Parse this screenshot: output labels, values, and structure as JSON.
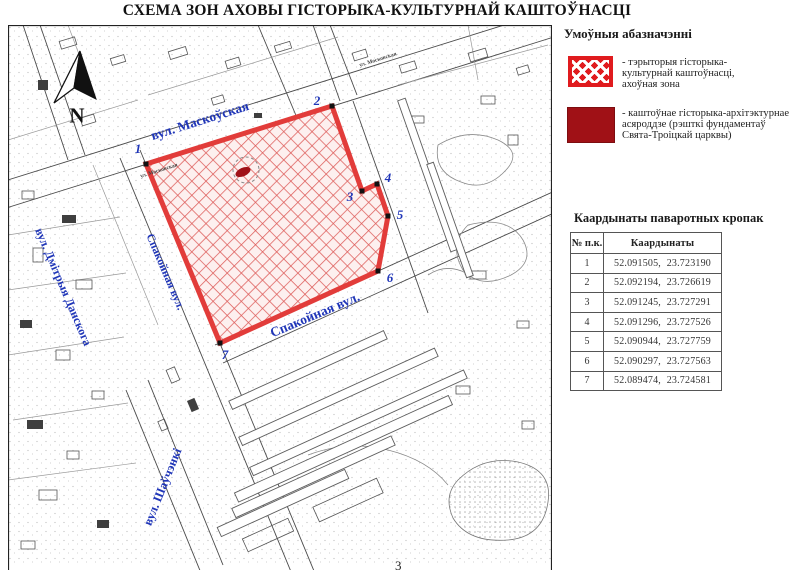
{
  "title": "СХЕМА ЗОН АХОВЫ ГІСТОРЫКА-КУЛЬТУРНАЙ КАШТОЎНАСЦІ",
  "map": {
    "north_label": "N",
    "page_mark": "3",
    "streets": {
      "maskouskaya": "вул. Маскоўская",
      "spakoynaya_vert": "Спакойная вул.",
      "spakoynaya_diag": "Спакойная вул.",
      "dmitryya": "вул. Дмітрыя Данскога",
      "shauchenki": "вул. Шаўчэнкі",
      "minor": "ул. Московская"
    },
    "points": [
      {
        "label": "1"
      },
      {
        "label": "2"
      },
      {
        "label": "3"
      },
      {
        "label": "4"
      },
      {
        "label": "5"
      },
      {
        "label": "6"
      },
      {
        "label": "7"
      }
    ]
  },
  "legend": {
    "heading": "Умоўныя абазначэнні",
    "items": [
      {
        "lines": [
          "- тэрыторыя гісторыка-",
          "культурнай каштоўнасці,",
          "ахоўная зона"
        ]
      },
      {
        "lines": [
          "- каштоўнае гісторыка-архітэктурнае",
          "асяроддзе (рэшткі фундаментаў",
          "Свята-Троіцкай царквы)"
        ]
      }
    ]
  },
  "coords": {
    "heading": "Каардынаты паваротных кропак",
    "col_num": "№ п.к.",
    "col_val": "Каардынаты",
    "rows": [
      {
        "num": "1",
        "val": "52.091505, 23.723190"
      },
      {
        "num": "2",
        "val": "52.092194, 23.726619"
      },
      {
        "num": "3",
        "val": "52.091245, 23.727291"
      },
      {
        "num": "4",
        "val": "52.091296, 23.727526"
      },
      {
        "num": "5",
        "val": "52.090944, 23.727759"
      },
      {
        "num": "6",
        "val": "52.090297, 23.727563"
      },
      {
        "num": "7",
        "val": "52.089474, 23.724581"
      }
    ]
  },
  "colors": {
    "zone_border_red": "#e23c3a",
    "zone_hatch_red": "#dd5c5a",
    "legend_red": "#e01b1e",
    "dark_red": "#a01116",
    "street_blue": "#2036b8"
  }
}
